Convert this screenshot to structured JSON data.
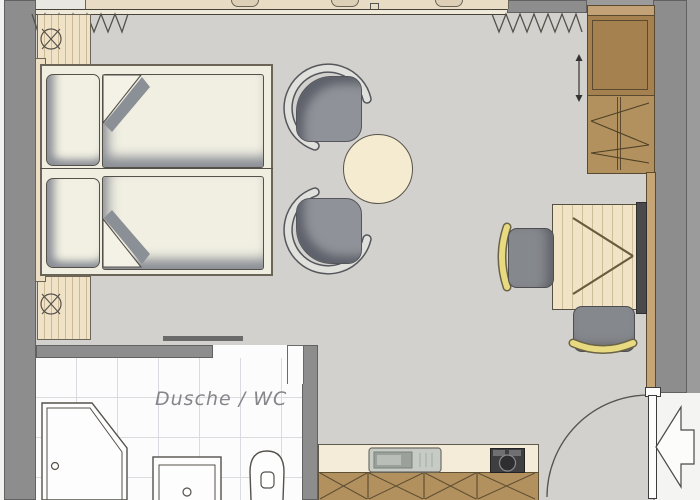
{
  "labels": {
    "bathroom": "Dusche / WC"
  },
  "colors": {
    "wall": "#8d8d8d",
    "outside": "#9b9b9b",
    "floor": "#d3d1cd",
    "line": "#55514a",
    "tile": "#fcfcfc",
    "tileline": "#dadbe0",
    "wood": "#b3915f",
    "wooddark": "#a5814f",
    "woodlight": "#f1e4c6",
    "sill": "#e8dcc4",
    "linen": "#f0eee1",
    "shadow": "#8b8f96",
    "cream": "#f4ebd1",
    "yellow": "#e8da80",
    "seat": "#8f9298",
    "white": "#fbfbfa",
    "dark": "#4a4a4c"
  },
  "icons": [
    "window-sill",
    "curtain-zigzag-left",
    "curtain-zigzag-right",
    "double-bed",
    "pillow",
    "duvet",
    "bedside-post-symbol",
    "armchair",
    "coffee-table",
    "wardrobe",
    "clothes-rail-zigzag",
    "sliding-arrow",
    "desk",
    "mirror-panel",
    "mirror-v-symbol",
    "desk-chair",
    "chair-yellow-arc",
    "bathroom-sliding-door",
    "shower",
    "washbasin",
    "toilet",
    "kitchen-counter",
    "kitchen-cabinet-x",
    "kitchen-sink",
    "coffee-machine",
    "entrance-door-leaf",
    "door-swing-arc",
    "entry-direction-arrow"
  ]
}
